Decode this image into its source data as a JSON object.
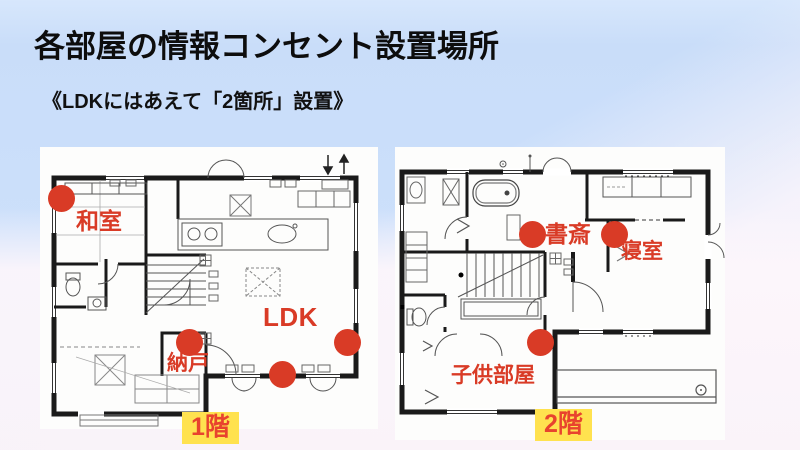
{
  "slide": {
    "title": "各部屋の情報コンセント設置場所",
    "subtitle": "《LDKにはあえて「2箇所」設置》"
  },
  "floor1": {
    "badge": "1階",
    "labels": {
      "washitsu": "和室",
      "nando": "納戸",
      "ldk": "LDK"
    },
    "outlet_count": 4
  },
  "floor2": {
    "badge": "2階",
    "labels": {
      "shosai": "書斎",
      "shinshitsu": "寝室",
      "kodomobeya": "子供部屋"
    },
    "outlet_count": 3
  },
  "colors": {
    "accent_red": "#d93b26",
    "badge_bg": "#ffe24f",
    "badge_text": "#e8432e",
    "bg_blue": "#cce0fb",
    "bg_pink": "#fdf6fb",
    "wall_black": "#1a1a1a"
  }
}
